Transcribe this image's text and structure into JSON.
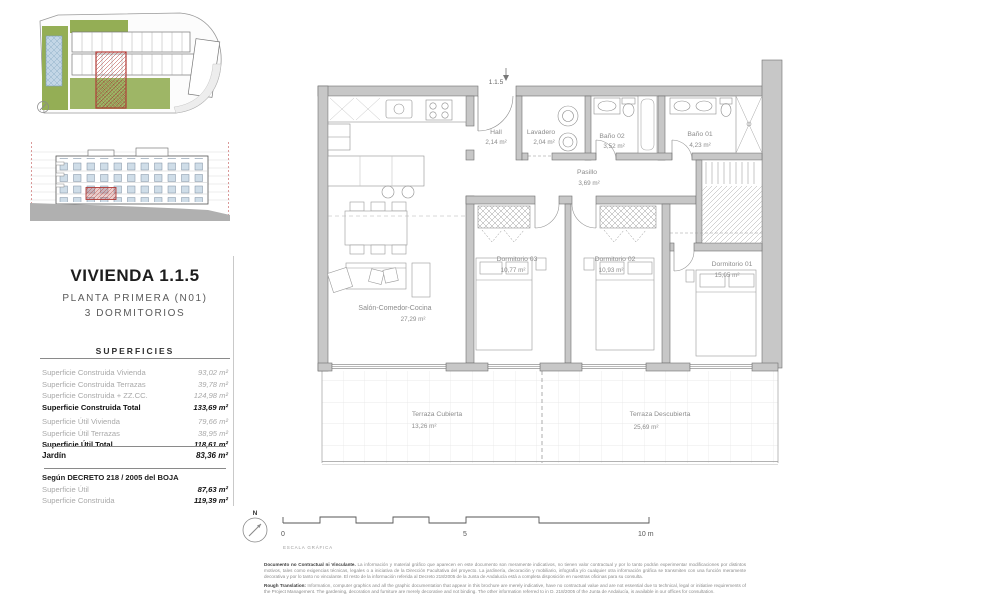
{
  "title_block": {
    "title": "VIVIENDA 1.1.5",
    "subtitle_line1": "PLANTA PRIMERA (N01)",
    "subtitle_line2": "3 DORMITORIOS"
  },
  "superficies": {
    "header": "SUPERFICIES",
    "rows": [
      {
        "label": "Superficie Construida Vivienda",
        "value": "93,02 m²"
      },
      {
        "label": "Superficie Construida Terrazas",
        "value": "39,78 m²"
      },
      {
        "label": "Superficie Construida + ZZ.CC.",
        "value": "124,98 m²"
      },
      {
        "label": "Superficie Construida Total",
        "value": "133,69 m²"
      },
      {
        "label": "Superficie Útil Vivienda",
        "value": "79,66 m²"
      },
      {
        "label": "Superficie Útil Terrazas",
        "value": "38,95 m²"
      },
      {
        "label": "Superficie Útil Total",
        "value": "118,61 m²"
      }
    ],
    "jardin": {
      "label": "Jardín",
      "value": "83,36 m²"
    },
    "decreto": {
      "header": "Según DECRETO 218 / 2005 del BOJA",
      "rows": [
        {
          "label": "Superficie Útil",
          "value": "87,63 m²"
        },
        {
          "label": "Superficie Construida",
          "value": "119,39 m²"
        }
      ]
    }
  },
  "plan": {
    "unit_label": "1.1.5",
    "rooms": {
      "hall": {
        "name": "Hall",
        "area": "2,14 m²"
      },
      "lavadero": {
        "name": "Lavadero",
        "area": "2,04 m²"
      },
      "bano02": {
        "name": "Baño 02",
        "area": "3,52 m²"
      },
      "bano01": {
        "name": "Baño 01",
        "area": "4,23 m²"
      },
      "pasillo": {
        "name": "Pasillo",
        "area": "3,69 m²"
      },
      "dorm03": {
        "name": "Dormitorio 03",
        "area": "10,77 m²"
      },
      "dorm02": {
        "name": "Dormitorio 02",
        "area": "10,93 m²"
      },
      "dorm01": {
        "name": "Dormitorio 01",
        "area": "15,05 m²"
      },
      "salon": {
        "name": "Salón-Comedor-Cocina",
        "area": "27,29 m²"
      },
      "terraza_cubierta": {
        "name": "Terraza Cubierta",
        "area": "13,26 m²"
      },
      "terraza_descubierta": {
        "name": "Terraza Descubierta",
        "area": "25,69 m²"
      }
    }
  },
  "scale_bar": {
    "tick0": "0",
    "tick5": "5",
    "tick10": "10 m",
    "caption": "ESCALA GRÁFICA"
  },
  "north": {
    "label": "N"
  },
  "legal": {
    "p1_lead": "Documento no Contractual ni Vinculante.",
    "p1_text": " La información y material gráfico que aparecen en este documento son meramente indicativos, no tienen valor contractual y por lo tanto podrán experimentar modificaciones por distintos motivos, tales como exigencias técnicas, legales o a iniciativa de la Dirección Facultativa del proyecto. La jardinería, decoración y mobiliario, infografía y/o cualquier otra información gráfica se transmiten con una función meramente decorativa y por lo tanto no vinculante. El resto de la información referida al Decreto 218/2005 de la Junta de Andalucía está a completa disposición en nuestras oficinas para su consulta.",
    "p2_lead": "Rough Translation:",
    "p2_text": " Information, computer graphics and all the graphic documentation that appear in this brochure are merely indicative, have no contractual value and are not essential due to technical, legal or initiative requirements of the Project Management. The gardening, decoration and furniture are merely decorative and not binding. The other information referred to in D. 218/2005 of the Junta de Andalucía, is available in our offices for consultation."
  },
  "colors": {
    "wall_fill": "#c7c7c7",
    "line": "#5a5a5a",
    "green": "#94ae55",
    "pool_blue": "#c3d6e6",
    "highlight_red": "#b23b37",
    "tile_line": "#e4e4e4"
  }
}
